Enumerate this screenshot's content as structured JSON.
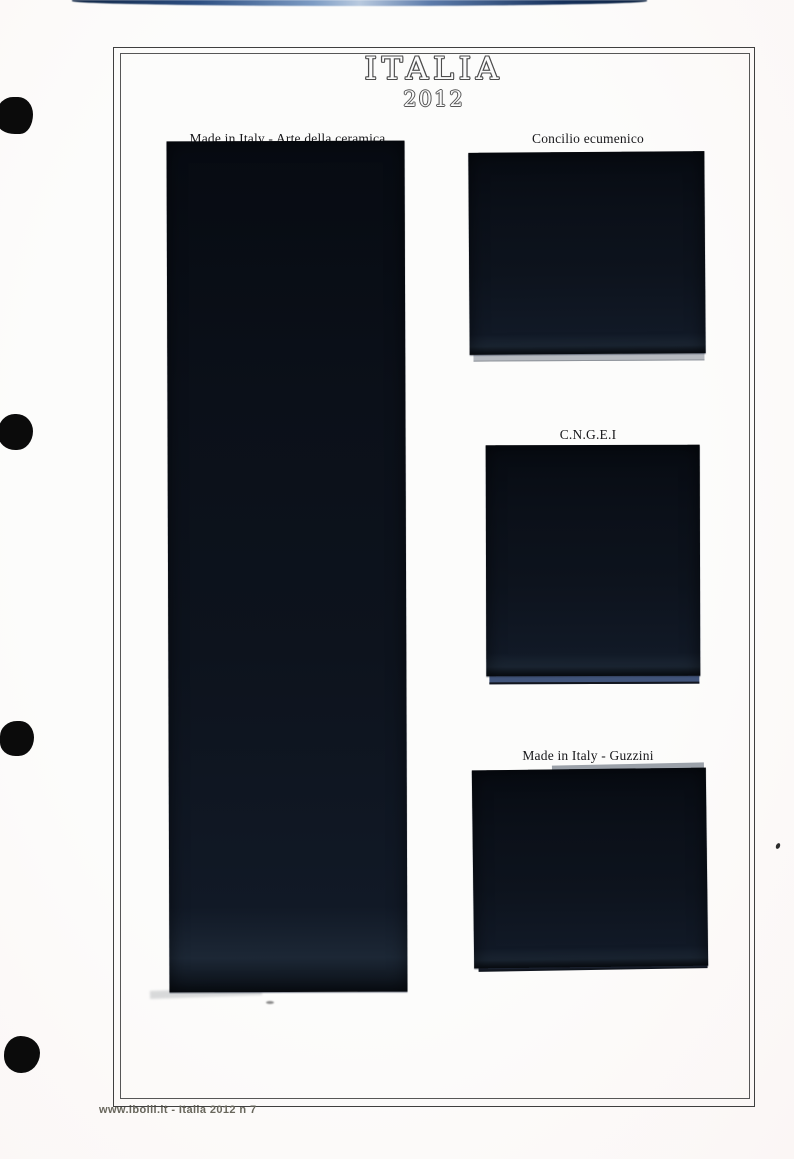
{
  "page": {
    "title": "ITALIA",
    "year": "2012",
    "footer_text": "www.ibolli.it - Italia 2012 n 7"
  },
  "stamp_slots": [
    {
      "label": "Made in Italy - Arte della ceramica",
      "column": "left",
      "mount": "tall strip mount"
    },
    {
      "label": "Concilio ecumenico",
      "column": "right",
      "mount": "block mount"
    },
    {
      "label": "C.N.G.E.I",
      "column": "right",
      "mount": "block mount"
    },
    {
      "label": "Made in Italy - Guzzini",
      "column": "right",
      "mount": "block mount"
    }
  ],
  "binder": {
    "hole_count": 4
  },
  "colors": {
    "mount_black": "#0b1019",
    "mount_sheen": "#1c2735",
    "backing_gray": "#b6bac0",
    "backing_blue": "#41547a",
    "frame_line": "#3f3f3f",
    "scan_strip_blue": "#2d4f82",
    "footer_text": "#68665c",
    "paper": "#fcfcfb"
  }
}
